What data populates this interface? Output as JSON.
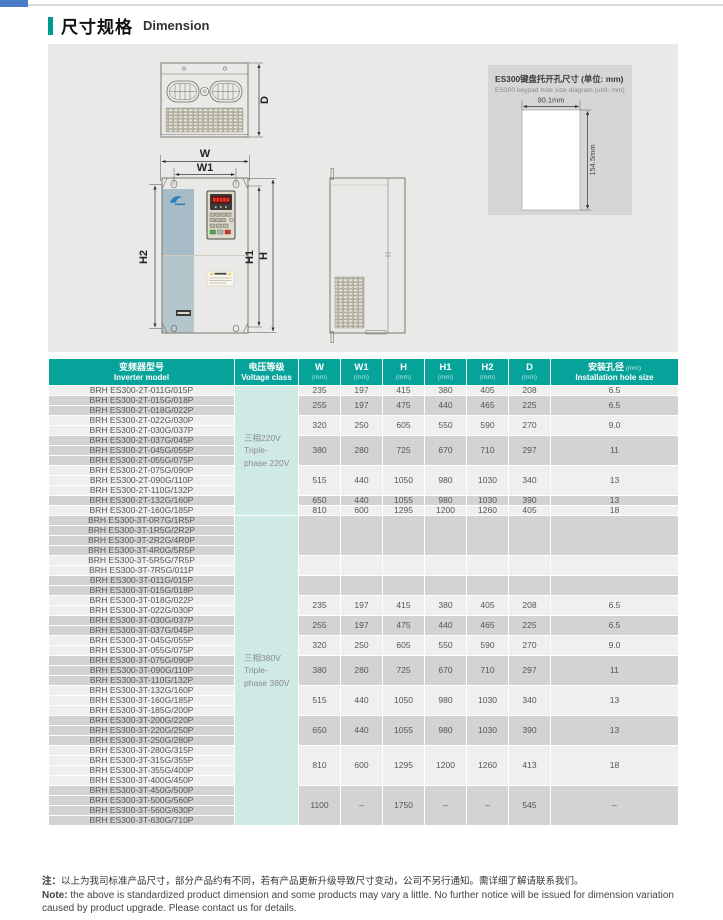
{
  "page": {
    "title_zh": "尺寸规格",
    "title_en": "Dimension"
  },
  "colors": {
    "top_chip_blue": "#4a7dc9",
    "title_accent_teal": "#00998f",
    "table_header_teal": "#05a39a",
    "voltage_cell_mint": "#cfe9e5",
    "row_light": "#efefed",
    "row_dark": "#d3d3d1",
    "panel_gray": "#e9e9e7"
  },
  "diagram": {
    "dim_labels": {
      "w": "W",
      "w1": "W1",
      "h": "H",
      "h1": "H1",
      "h2": "H2",
      "d": "D"
    },
    "keypad_box": {
      "title_zh": "ES300键盘托开孔尺寸 (单位: mm)",
      "title_en": "ES300 keypad hole size diagram (unit: mm)",
      "width_label": "90.1mm",
      "height_label": "154.5mm"
    }
  },
  "table": {
    "columns": [
      {
        "l1": "变频器型号",
        "l2": "Inverter model"
      },
      {
        "l1": "电压等级",
        "l2": "Voltage class"
      },
      {
        "l1": "W",
        "l2": "(mm)",
        "dim": true
      },
      {
        "l1": "W1",
        "l2": "(mm)",
        "dim": true
      },
      {
        "l1": "H",
        "l2": "(mm)",
        "dim": true
      },
      {
        "l1": "H1",
        "l2": "(mm)",
        "dim": true
      },
      {
        "l1": "H2",
        "l2": "(mm)",
        "dim": true
      },
      {
        "l1": "D",
        "l2": "(mm)",
        "dim": true
      },
      {
        "l1": "安装孔径",
        "unit": "(mm)",
        "l2": "Installation hole size"
      }
    ],
    "sections": [
      {
        "voltage_zh": "三相220V",
        "voltage_en1": "Triple-",
        "voltage_en2": "phase 220V",
        "groups": [
          {
            "models": [
              "BRH ES300-2T-011G/015P"
            ],
            "dims": [
              "235",
              "197",
              "415",
              "380",
              "405",
              "208",
              "6.5"
            ]
          },
          {
            "models": [
              "BRH ES300-2T-015G/018P",
              "BRH ES300-2T-018G/022P"
            ],
            "dims": [
              "255",
              "197",
              "475",
              "440",
              "465",
              "225",
              "6.5"
            ]
          },
          {
            "models": [
              "BRH ES300-2T-022G/030P",
              "BRH ES300-2T-030G/037P"
            ],
            "dims": [
              "320",
              "250",
              "605",
              "550",
              "590",
              "270",
              "9.0"
            ]
          },
          {
            "models": [
              "BRH ES300-2T-037G/045P",
              "BRH ES300-2T-045G/055P",
              "BRH ES300-2T-055G/075P"
            ],
            "dims": [
              "380",
              "280",
              "725",
              "670",
              "710",
              "297",
              "11"
            ]
          },
          {
            "models": [
              "BRH ES300-2T-075G/090P",
              "BRH ES300-2T-090G/110P",
              "BRH ES300-2T-110G/132P"
            ],
            "dims": [
              "515",
              "440",
              "1050",
              "980",
              "1030",
              "340",
              "13"
            ]
          },
          {
            "models": [
              "BRH ES300-2T-132G/160P"
            ],
            "dims": [
              "650",
              "440",
              "1055",
              "980",
              "1030",
              "390",
              "13"
            ]
          },
          {
            "models": [
              "BRH ES300-2T-160G/185P"
            ],
            "dims": [
              "810",
              "600",
              "1295",
              "1200",
              "1260",
              "405",
              "18"
            ]
          }
        ]
      },
      {
        "voltage_zh": "三相380V",
        "voltage_en1": "Triple-",
        "voltage_en2": "phase 380V",
        "groups": [
          {
            "models": [
              "BRH ES300-3T-0R7G/1R5P",
              "BRH ES300-3T-1R5G/2R2P",
              "BRH ES300-3T-2R2G/4R0P",
              "BRH ES300-3T-4R0G/5R5P"
            ],
            "dims": [
              "",
              "",
              "",
              "",
              "",
              "",
              ""
            ]
          },
          {
            "models": [
              "BRH ES300-3T-5R5G/7R5P",
              "BRH ES300-3T-7R5G/011P"
            ],
            "dims": [
              "",
              "",
              "",
              "",
              "",
              "",
              ""
            ]
          },
          {
            "models": [
              "BRH ES300-3T-011G/015P",
              "BRH ES300-3T-015G/018P"
            ],
            "dims": [
              "",
              "",
              "",
              "",
              "",
              "",
              ""
            ]
          },
          {
            "models": [
              "BRH ES300-3T-018G/022P",
              "BRH ES300-3T-022G/030P"
            ],
            "dims": [
              "235",
              "197",
              "415",
              "380",
              "405",
              "208",
              "6.5"
            ]
          },
          {
            "models": [
              "BRH ES300-3T-030G/037P",
              "BRH ES300-3T-037G/045P"
            ],
            "dims": [
              "255",
              "197",
              "475",
              "440",
              "465",
              "225",
              "6.5"
            ]
          },
          {
            "models": [
              "BRH ES300-3T-045G/055P",
              "BRH ES300-3T-055G/075P"
            ],
            "dims": [
              "320",
              "250",
              "605",
              "550",
              "590",
              "270",
              "9.0"
            ]
          },
          {
            "models": [
              "BRH ES300-3T-075G/090P",
              "BRH ES300-3T-090G/110P",
              "BRH ES300-3T-110G/132P"
            ],
            "dims": [
              "380",
              "280",
              "725",
              "670",
              "710",
              "297",
              "11"
            ]
          },
          {
            "models": [
              "BRH ES300-3T-132G/160P",
              "BRH ES300-3T-160G/185P",
              "BRH ES300-3T-185G/200P"
            ],
            "dims": [
              "515",
              "440",
              "1050",
              "980",
              "1030",
              "340",
              "13"
            ]
          },
          {
            "models": [
              "BRH ES300-3T-200G/220P",
              "BRH ES300-3T-220G/250P",
              "BRH ES300-3T-250G/280P"
            ],
            "dims": [
              "650",
              "440",
              "1055",
              "980",
              "1030",
              "390",
              "13"
            ]
          },
          {
            "models": [
              "BRH ES300-3T-280G/315P",
              "BRH ES300-3T-315G/355P",
              "BRH ES300-3T-355G/400P",
              "BRH ES300-3T-400G/450P"
            ],
            "dims": [
              "810",
              "600",
              "1295",
              "1200",
              "1260",
              "413",
              "18"
            ]
          },
          {
            "models": [
              "BRH ES300-3T-450G/500P",
              "BRH ES300-3T-500G/560P",
              "BRH ES300-3T-560G/630P",
              "BRH ES300-3T-630G/710P"
            ],
            "dims": [
              "1100",
              "–",
              "1750",
              "–",
              "–",
              "545",
              "–"
            ]
          }
        ]
      }
    ]
  },
  "notes": {
    "zh_prefix": "注：",
    "zh": "以上为我司标准产品尺寸，部分产品约有不同，若有产品更新升级导致尺寸变动，公司不另行通知。需详细了解请联系我们。",
    "en_prefix": "Note:",
    "en": " the above is standardized product dimension and some products may vary a little. No further notice will be issued for dimension variation caused by product upgrade. Please contact us for details."
  }
}
